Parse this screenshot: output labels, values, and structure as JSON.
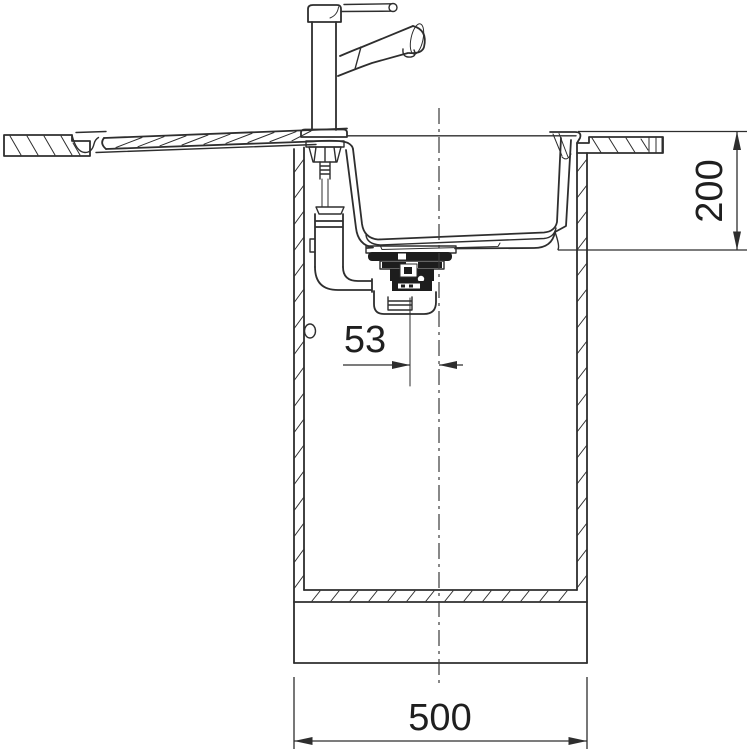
{
  "canvas": {
    "background": "#ffffff",
    "stroke_color": "#2e2e2e",
    "dark_fill": "#1d1d1d"
  },
  "drawing": {
    "annotations": {
      "bowl_depth": {
        "value": "200",
        "orientation": "vertical",
        "position": "right"
      },
      "drain_offset": {
        "value": "53",
        "orientation": "horizontal",
        "position": "center"
      },
      "cabinet_width": {
        "value": "500",
        "orientation": "horizontal",
        "position": "bottom"
      }
    }
  }
}
